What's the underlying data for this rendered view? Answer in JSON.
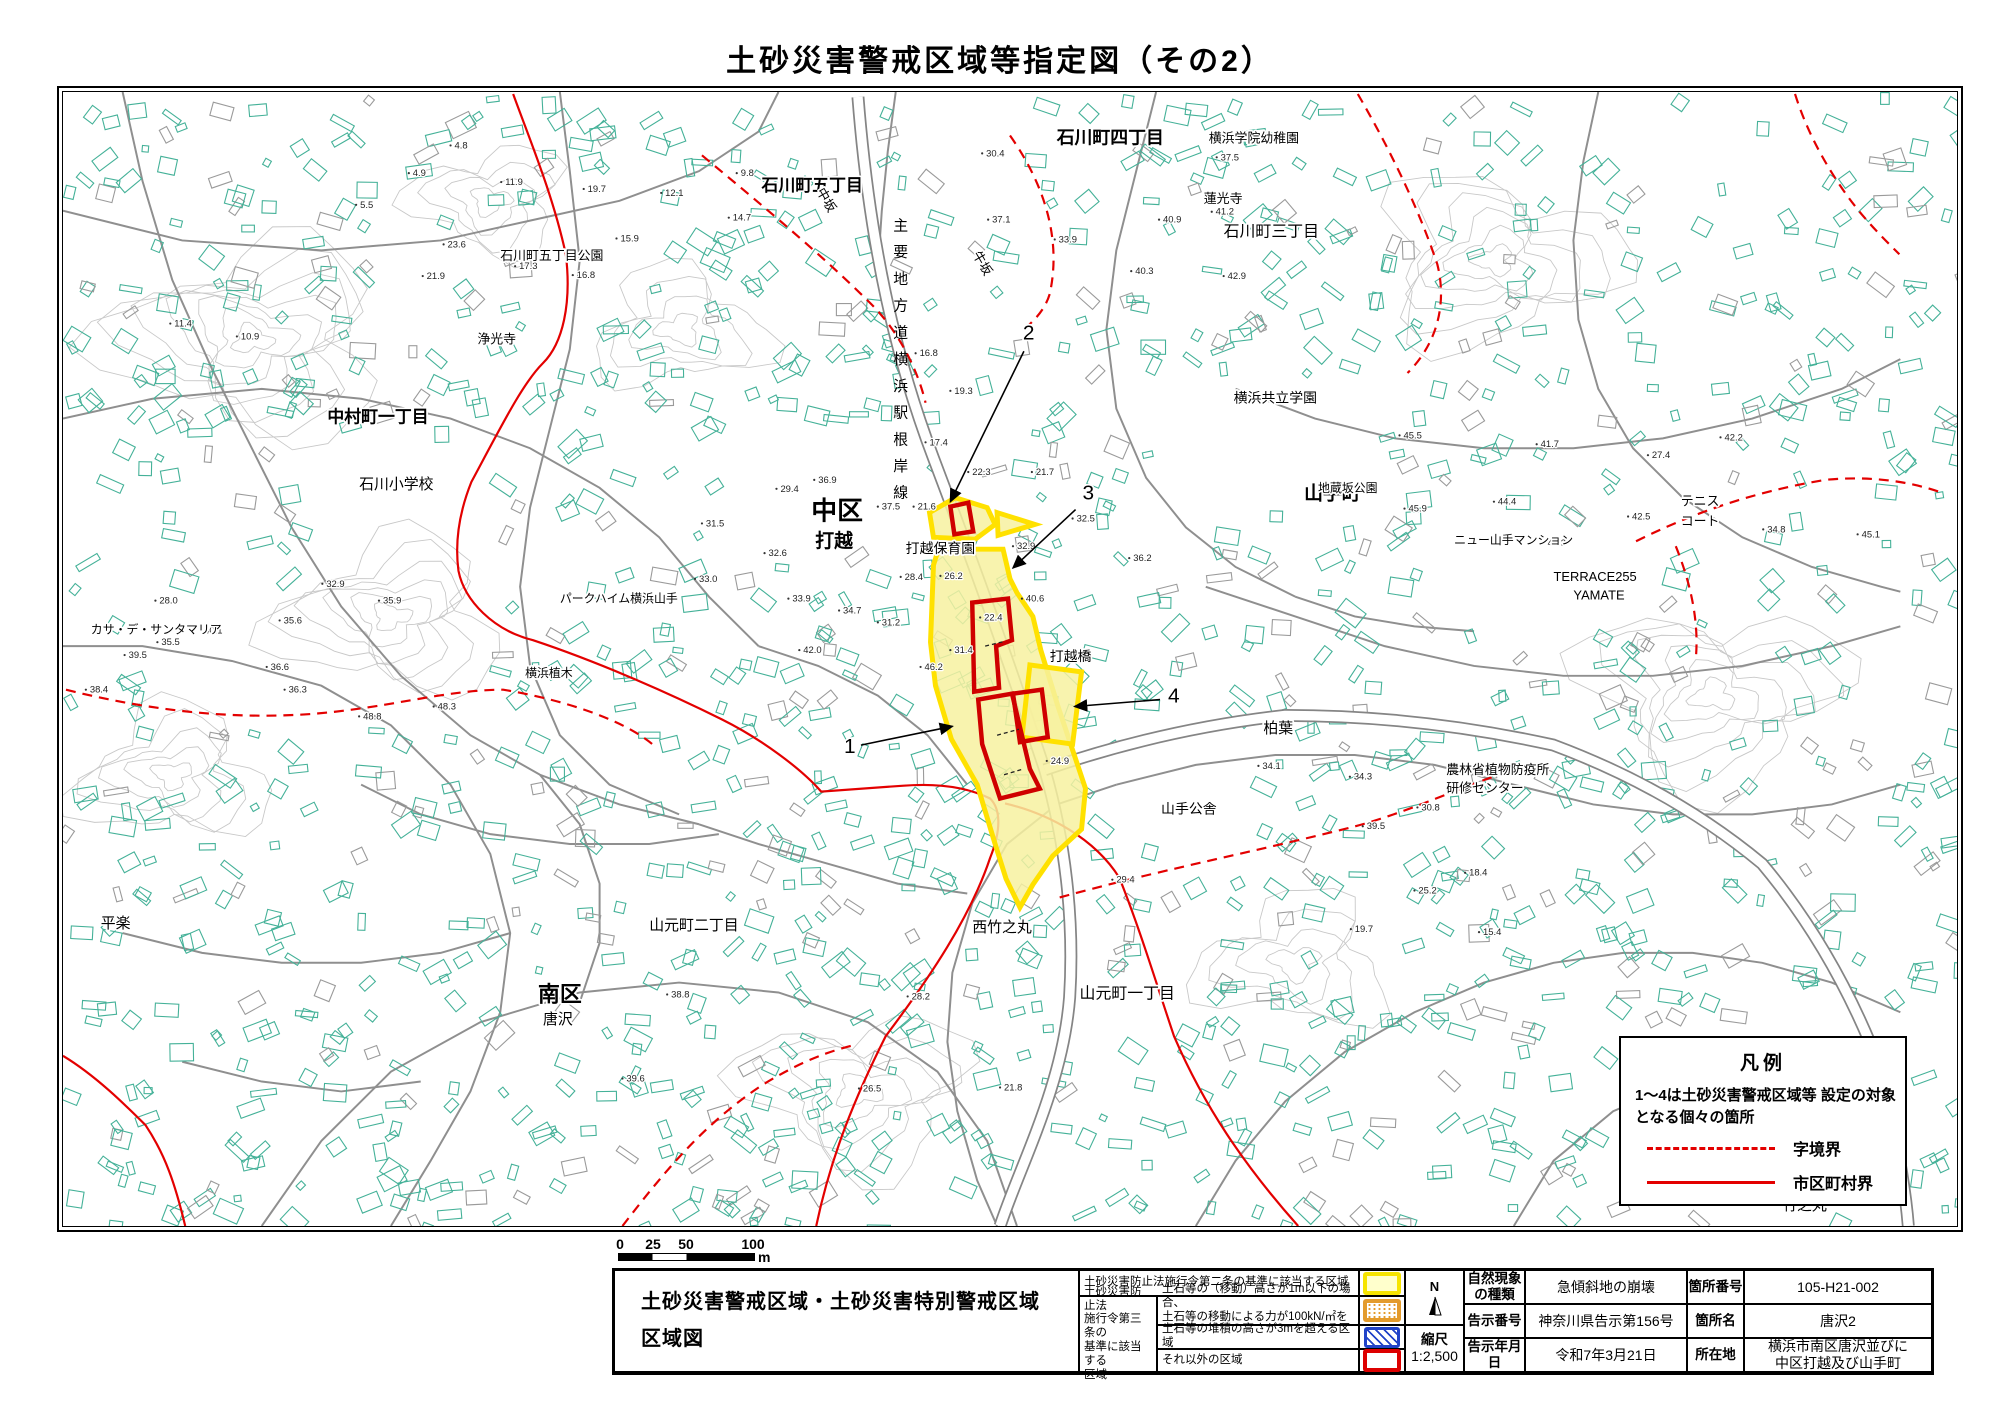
{
  "page_title": "土砂災害警戒区域等指定図（その2）",
  "map": {
    "road_label_vertical": "主要地方道横浜駅根岸線",
    "colors": {
      "building": "#44b198",
      "building_gray": "#9a9a9a",
      "road": "#8f8f8f",
      "contour": "#c8c8c8",
      "boundary_red": "#e30000",
      "zone_yellow_fill": "#f7f1a0",
      "zone_yellow_border": "#ffe100",
      "zone_red": "#cf0000"
    },
    "legend": {
      "title": "凡例",
      "note1": "1〜4は土砂災害警戒区域等",
      "note2": "設定の対象となる個々の箇所",
      "dashed_label": "字境界",
      "solid_label": "市区町村界"
    },
    "place_labels": [
      {
        "t": "石川町五丁目",
        "x": 703,
        "y": 100,
        "s": 17
      },
      {
        "t": "石川町五丁目公園",
        "x": 440,
        "y": 170,
        "s": 13
      },
      {
        "t": "石川町四丁目",
        "x": 1000,
        "y": 52,
        "s": 18
      },
      {
        "t": "横浜学院幼稚園",
        "x": 1153,
        "y": 51,
        "s": 13
      },
      {
        "t": "牛坂",
        "x": 915,
        "y": 164,
        "s": 13,
        "r": 60
      },
      {
        "t": "中坂",
        "x": 758,
        "y": 100,
        "s": 13,
        "r": 60
      },
      {
        "t": "浄光寺",
        "x": 417,
        "y": 254,
        "s": 13
      },
      {
        "t": "中村町一丁目",
        "x": 266,
        "y": 334,
        "s": 17
      },
      {
        "t": "石川小学校",
        "x": 298,
        "y": 401,
        "s": 15
      },
      {
        "t": "中区",
        "x": 753,
        "y": 432,
        "s": 26
      },
      {
        "t": "打越",
        "x": 757,
        "y": 460,
        "s": 19
      },
      {
        "t": "打越保育園",
        "x": 848,
        "y": 466,
        "s": 14
      },
      {
        "t": "打越橋",
        "x": 993,
        "y": 575,
        "s": 14
      },
      {
        "t": "横浜共立学園",
        "x": 1178,
        "y": 314,
        "s": 14
      },
      {
        "t": "山手町",
        "x": 1249,
        "y": 412,
        "s": 19
      },
      {
        "t": "蓮光寺",
        "x": 1148,
        "y": 112,
        "s": 13
      },
      {
        "t": "石川町三丁目",
        "x": 1168,
        "y": 146,
        "s": 16
      },
      {
        "t": "テニス",
        "x": 1628,
        "y": 418,
        "s": 13
      },
      {
        "t": "コート",
        "x": 1628,
        "y": 438,
        "s": 13
      },
      {
        "t": "ニュー山手マンション",
        "x": 1400,
        "y": 457,
        "s": 12
      },
      {
        "t": "TERRACE255",
        "x": 1500,
        "y": 494,
        "s": 13
      },
      {
        "t": "YAMATE",
        "x": 1520,
        "y": 513,
        "s": 13
      },
      {
        "t": "地蔵坂公園",
        "x": 1263,
        "y": 404,
        "s": 12
      },
      {
        "t": "山手公舎",
        "x": 1105,
        "y": 729,
        "s": 14
      },
      {
        "t": "農林省植物防疫所",
        "x": 1392,
        "y": 689,
        "s": 13
      },
      {
        "t": "研修センター",
        "x": 1392,
        "y": 708,
        "s": 13
      },
      {
        "t": "パークハイム横浜山手",
        "x": 500,
        "y": 516,
        "s": 12
      },
      {
        "t": "横浜植木",
        "x": 465,
        "y": 591,
        "s": 12
      },
      {
        "t": "カサ・デ・サンタマリア",
        "x": 28,
        "y": 547,
        "s": 12
      },
      {
        "t": "南区",
        "x": 478,
        "y": 919,
        "s": 22
      },
      {
        "t": "唐沢",
        "x": 483,
        "y": 942,
        "s": 15
      },
      {
        "t": "平楽",
        "x": 38,
        "y": 845,
        "s": 15
      },
      {
        "t": "山元町一丁目",
        "x": 1023,
        "y": 916,
        "s": 16
      },
      {
        "t": "山元町二丁目",
        "x": 590,
        "y": 847,
        "s": 15
      },
      {
        "t": "西竹之丸",
        "x": 915,
        "y": 849,
        "s": 15
      },
      {
        "t": "柏葉",
        "x": 1208,
        "y": 648,
        "s": 15
      },
      {
        "t": "竹之丸",
        "x": 1730,
        "y": 1130,
        "s": 15
      }
    ],
    "area_numbers": [
      {
        "n": "1",
        "x": 786,
        "y": 668,
        "line": [
          803,
          660,
          895,
          641
        ]
      },
      {
        "n": "2",
        "x": 966,
        "y": 250,
        "line": [
          967,
          262,
          893,
          414
        ]
      },
      {
        "n": "3",
        "x": 1026,
        "y": 412,
        "line": [
          1019,
          422,
          956,
          481
        ]
      },
      {
        "n": "4",
        "x": 1112,
        "y": 617,
        "line": [
          1104,
          614,
          1018,
          621
        ]
      }
    ],
    "elevations": [
      {
        "x": 390,
        "y": 54,
        "v": "4.8"
      },
      {
        "x": 348,
        "y": 82,
        "v": "4.9"
      },
      {
        "x": 295,
        "y": 114,
        "v": "5.5"
      },
      {
        "x": 441,
        "y": 91,
        "v": "11.9"
      },
      {
        "x": 524,
        "y": 98,
        "v": "19.7"
      },
      {
        "x": 602,
        "y": 102,
        "v": "12.1"
      },
      {
        "x": 678,
        "y": 82,
        "v": "9.8"
      },
      {
        "x": 455,
        "y": 176,
        "v": "17.3"
      },
      {
        "x": 513,
        "y": 185,
        "v": "16.8"
      },
      {
        "x": 383,
        "y": 154,
        "v": "23.6"
      },
      {
        "x": 557,
        "y": 148,
        "v": "15.9"
      },
      {
        "x": 670,
        "y": 127,
        "v": "14.7"
      },
      {
        "x": 362,
        "y": 186,
        "v": "21.9"
      },
      {
        "x": 108,
        "y": 234,
        "v": "11.4"
      },
      {
        "x": 175,
        "y": 247,
        "v": "10.9"
      },
      {
        "x": 925,
        "y": 62,
        "v": "30.4"
      },
      {
        "x": 931,
        "y": 129,
        "v": "37.1"
      },
      {
        "x": 998,
        "y": 149,
        "v": "33.9"
      },
      {
        "x": 1075,
        "y": 181,
        "v": "40.3"
      },
      {
        "x": 1168,
        "y": 186,
        "v": "42.9"
      },
      {
        "x": 1161,
        "y": 66,
        "v": "37.5"
      },
      {
        "x": 1103,
        "y": 129,
        "v": "40.9"
      },
      {
        "x": 1156,
        "y": 121,
        "v": "41.2"
      },
      {
        "x": 858,
        "y": 264,
        "v": "16.8"
      },
      {
        "x": 893,
        "y": 302,
        "v": "19.3"
      },
      {
        "x": 868,
        "y": 354,
        "v": "17.4"
      },
      {
        "x": 911,
        "y": 384,
        "v": "22.3"
      },
      {
        "x": 975,
        "y": 384,
        "v": "21.7"
      },
      {
        "x": 1016,
        "y": 431,
        "v": "32.5"
      },
      {
        "x": 1073,
        "y": 471,
        "v": "36.2"
      },
      {
        "x": 956,
        "y": 459,
        "v": "32.9"
      },
      {
        "x": 965,
        "y": 512,
        "v": "40.6"
      },
      {
        "x": 883,
        "y": 489,
        "v": "26.2"
      },
      {
        "x": 843,
        "y": 490,
        "v": "28.4"
      },
      {
        "x": 893,
        "y": 564,
        "v": "31.4"
      },
      {
        "x": 923,
        "y": 531,
        "v": "22.4"
      },
      {
        "x": 990,
        "y": 676,
        "v": "24.9"
      },
      {
        "x": 856,
        "y": 419,
        "v": "21.6"
      },
      {
        "x": 756,
        "y": 392,
        "v": "36.9"
      },
      {
        "x": 820,
        "y": 419,
        "v": "37.5"
      },
      {
        "x": 718,
        "y": 401,
        "v": "29.4"
      },
      {
        "x": 643,
        "y": 436,
        "v": "31.5"
      },
      {
        "x": 706,
        "y": 466,
        "v": "32.6"
      },
      {
        "x": 636,
        "y": 492,
        "v": "33.0"
      },
      {
        "x": 730,
        "y": 512,
        "v": "33.9"
      },
      {
        "x": 781,
        "y": 524,
        "v": "34.7"
      },
      {
        "x": 820,
        "y": 536,
        "v": "31.2"
      },
      {
        "x": 863,
        "y": 581,
        "v": "46.2"
      },
      {
        "x": 741,
        "y": 564,
        "v": "42.0"
      },
      {
        "x": 1345,
        "y": 347,
        "v": "45.5"
      },
      {
        "x": 1483,
        "y": 356,
        "v": "41.7"
      },
      {
        "x": 1595,
        "y": 367,
        "v": "27.4"
      },
      {
        "x": 1575,
        "y": 429,
        "v": "42.5"
      },
      {
        "x": 1440,
        "y": 414,
        "v": "44.4"
      },
      {
        "x": 1350,
        "y": 421,
        "v": "45.9"
      },
      {
        "x": 1490,
        "y": 456,
        "v": "43.3"
      },
      {
        "x": 1711,
        "y": 442,
        "v": "34.8"
      },
      {
        "x": 1806,
        "y": 447,
        "v": "45.1"
      },
      {
        "x": 1668,
        "y": 349,
        "v": "42.2"
      },
      {
        "x": 1411,
        "y": 789,
        "v": "18.4"
      },
      {
        "x": 1360,
        "y": 807,
        "v": "25.2"
      },
      {
        "x": 1363,
        "y": 723,
        "v": "30.8"
      },
      {
        "x": 1296,
        "y": 846,
        "v": "19.7"
      },
      {
        "x": 1425,
        "y": 849,
        "v": "15.4"
      },
      {
        "x": 1295,
        "y": 692,
        "v": "34.3"
      },
      {
        "x": 1203,
        "y": 681,
        "v": "34.1"
      },
      {
        "x": 1308,
        "y": 742,
        "v": "39.5"
      },
      {
        "x": 1056,
        "y": 796,
        "v": "29.4"
      },
      {
        "x": 608,
        "y": 912,
        "v": "38.8"
      },
      {
        "x": 563,
        "y": 997,
        "v": "39.6"
      },
      {
        "x": 850,
        "y": 914,
        "v": "28.2"
      },
      {
        "x": 801,
        "y": 1007,
        "v": "26.5"
      },
      {
        "x": 943,
        "y": 1006,
        "v": "21.8"
      },
      {
        "x": 62,
        "y": 569,
        "v": "39.5"
      },
      {
        "x": 95,
        "y": 556,
        "v": "35.5"
      },
      {
        "x": 138,
        "y": 544,
        "v": "40.1"
      },
      {
        "x": 218,
        "y": 534,
        "v": "35.6"
      },
      {
        "x": 205,
        "y": 581,
        "v": "36.6"
      },
      {
        "x": 223,
        "y": 604,
        "v": "36.3"
      },
      {
        "x": 318,
        "y": 514,
        "v": "35.9"
      },
      {
        "x": 93,
        "y": 514,
        "v": "28.0"
      },
      {
        "x": 261,
        "y": 497,
        "v": "32.9"
      },
      {
        "x": 298,
        "y": 631,
        "v": "48.8"
      },
      {
        "x": 373,
        "y": 621,
        "v": "48.3"
      },
      {
        "x": 23,
        "y": 604,
        "v": "38.4"
      }
    ]
  },
  "scale_bar": {
    "ticks": [
      "0",
      "25",
      "50",
      "100"
    ],
    "unit": "m"
  },
  "info_table": {
    "map_title_line1": "土砂災害警戒区域・土砂災害特別警戒区域",
    "map_title_line2": "区域図",
    "law2_label": "土砂災害防止法施行令第二条の基準に該当する区域",
    "law3_lines": [
      "土砂災害防止法",
      "施行令第三条の",
      "基準に該当する",
      "区域"
    ],
    "row2_desc_line1": "土石等の（移動）高さが1m以下の場合、",
    "row2_desc_line2": "土石等の移動による力が100kN/㎡を超える区域",
    "row3_desc": "土石等の堆積の高さが3mを超える区域",
    "row4_desc": "それ以外の区域",
    "compass_n": "N",
    "scale_label": "縮尺",
    "scale_value": "1:2,500",
    "rows": [
      {
        "l1a": "自然現象",
        "l1b": "の種類",
        "v1": "急傾斜地の崩壊",
        "l2": "箇所番号",
        "v2": "105-H21-002"
      },
      {
        "l1a": "告示番号",
        "l1b": "",
        "v1": "神奈川県告示第156号",
        "l2": "箇所名",
        "v2": "唐沢2"
      },
      {
        "l1a": "告示年月日",
        "l1b": "",
        "v1": "令和7年3月21日",
        "l2": "所在地",
        "v2": "横浜市南区唐沢並びに",
        "v2b": "中区打越及び山手町"
      }
    ]
  },
  "geometry": {
    "contours": [
      {
        "cx": 190,
        "cy": 250,
        "r": 160,
        "n": 7
      },
      {
        "cx": 330,
        "cy": 530,
        "r": 130,
        "n": 6
      },
      {
        "cx": 110,
        "cy": 690,
        "r": 110,
        "n": 5
      },
      {
        "cx": 1440,
        "cy": 170,
        "r": 140,
        "n": 6
      },
      {
        "cx": 1660,
        "cy": 610,
        "r": 150,
        "n": 6
      },
      {
        "cx": 800,
        "cy": 1010,
        "r": 130,
        "n": 5
      },
      {
        "cx": 430,
        "cy": 110,
        "r": 90,
        "n": 4
      },
      {
        "cx": 1240,
        "cy": 880,
        "r": 110,
        "n": 4
      },
      {
        "cx": 620,
        "cy": 240,
        "r": 100,
        "n": 4
      }
    ],
    "roads_minor": [
      "M0,120 L120,150 260,160 380,150 470,130 560,110 640,80 700,40 720,0",
      "M0,330 L90,310 200,300 300,310 390,330 470,360 540,400 600,450 650,510 700,560",
      "M60,0 L80,90 110,190 150,280 190,360 230,440 280,520 340,590 410,650 480,690 560,720 640,740",
      "M0,560 L80,560 170,575 260,600 330,640 390,700 430,770 450,850 440,930 410,1010 370,1080 330,1146",
      "M200,1146 L260,1060 330,990 420,940 520,910 620,900 720,910 810,940 880,990 930,1060 960,1146",
      "M500,0 L510,80 520,170 510,260 490,340 470,420 460,500 470,580 500,650 550,700 620,730",
      "M640,740 L700,760 770,780 840,800 910,810",
      "M1100,0 L1080,80 1060,160 1050,240 1060,320 1090,390 1130,440 1180,480 1240,510",
      "M1180,300 L1260,330 1340,350 1430,360 1520,360 1610,350 1700,330 1790,300 1849,270",
      "M1150,500 L1240,530 1330,560 1420,580 1510,590 1600,590 1690,580 1780,560 1849,540",
      "M1545,0 L1530,70 1520,150 1525,230 1545,300 1580,360 1630,410 1690,450 1760,480 1830,500 1849,505",
      "M1849,700 L1780,720 1700,730 1620,730 1540,720 1460,700 1380,680 1300,670 1220,670 1140,680 1060,700",
      "M1060,700 L1000,720 950,760 915,820 895,890 890,960 900,1030 920,1100 940,1146",
      "M300,700 L360,730 430,750 510,760 590,760 660,750",
      "M60,850 L140,870 220,880 300,880 380,870 450,850",
      "M480,690 L520,740 540,800 540,860 520,920",
      "M1140,1146 L1180,1080 1230,1020 1290,970 1360,930 1430,900 1500,880 1570,870 1640,870 1710,880 1780,900 1849,930",
      "M700,560 L760,580 820,610 870,650 910,700",
      "M838,0 L830,60 824,120 820,180",
      "M1240,510 L1300,530 1360,540 1420,545",
      "M120,980 L200,1000 280,1010 360,1000",
      "M1460,1146 L1500,1080 1560,1030 1630,1000 1710,990 1790,1000 1849,1020"
    ],
    "roads_wide": [
      "M800,5 C812,160 840,275 876,370 C908,455 945,555 988,685 C1008,755 1018,835 1013,915 C1006,1005 963,1085 943,1146",
      "M988,685 C1060,660 1140,640 1230,630 C1320,630 1410,640 1500,660 C1580,690 1650,730 1710,780 C1760,840 1800,910 1830,990 C1850,1080 1855,1120 1857,1146"
    ],
    "boundaries_solid": [
      "M453,2 C470,49 493,104 506,164 C512,214 503,254 483,274 C463,294 443,334 411,394 C399,424 394,454 398,484 C404,514 433,544 473,554 C533,574 603,604 663,634 C703,654 743,684 763,707 L846,701 C886,698 913,704 933,714 C943,724 945,744 933,774 C913,834 873,894 828,954 C798,1014 773,1074 758,1146",
      "M948,719 C991,729 1038,754 1063,794 C1083,844 1098,894 1118,954 C1148,1024 1188,1084 1243,1146",
      "M0,974 C33,994 63,1024 83,1044 C103,1074 113,1104 123,1146"
    ],
    "boundaries_dashed": [
      "M643,64 C703,114 763,164 813,214 C843,244 861,284 868,314",
      "M953,44 C988,94 1005,149 993,204 C987,224 973,234 963,244",
      "M1303,2 C1333,54 1363,114 1383,174 C1393,214 1383,254 1353,284",
      "M1583,454 C1643,424 1703,404 1773,392 C1813,388 1853,392 1888,404",
      "M1623,459 C1637,494 1647,534 1643,574",
      "M3,604 C83,624 163,634 243,629 C323,624 383,604 443,604 C503,614 563,634 593,659",
      "M563,1146 C603,1094 643,1044 703,1004 C743,979 773,969 793,964",
      "M1003,814 C1093,789 1193,769 1293,744 C1353,729 1413,699 1463,684",
      "M1743,2 C1753,34 1768,64 1788,94 C1808,124 1828,144 1848,164"
    ],
    "zones_yellow": [
      "872,425 898,410 930,420 938,437 918,452 876,450",
      "940,425 978,437 941,448",
      "881,462 946,462 953,492 960,506 976,530 984,564 1001,620 1029,704 1025,745 996,772 976,801 963,824 949,795 938,760 920,700 894,654 878,600 873,556 876,478",
      "973,579 1025,586 1016,659 965,652"
    ],
    "zones_red": [
      "893,419 911,415 916,444 897,447",
      "915,516 951,512 955,554 939,560 942,602 917,606",
      "921,614 955,608 973,684 983,704 943,714 925,659",
      "956,608 985,604 991,652 963,657"
    ],
    "zone_ticks": [
      "M928,560 l20,-5",
      "M940,650 l22,-6",
      "M947,690 l20,-6"
    ],
    "exclusions": [
      [
        240,
        340,
        190,
        160
      ],
      [
        1090,
        290,
        230,
        130
      ],
      [
        650,
        330,
        190,
        140
      ],
      [
        90,
        500,
        330,
        140
      ],
      [
        1570,
        390,
        140,
        80
      ],
      [
        1380,
        430,
        170,
        90
      ],
      [
        1550,
        935,
        310,
        190
      ]
    ]
  }
}
